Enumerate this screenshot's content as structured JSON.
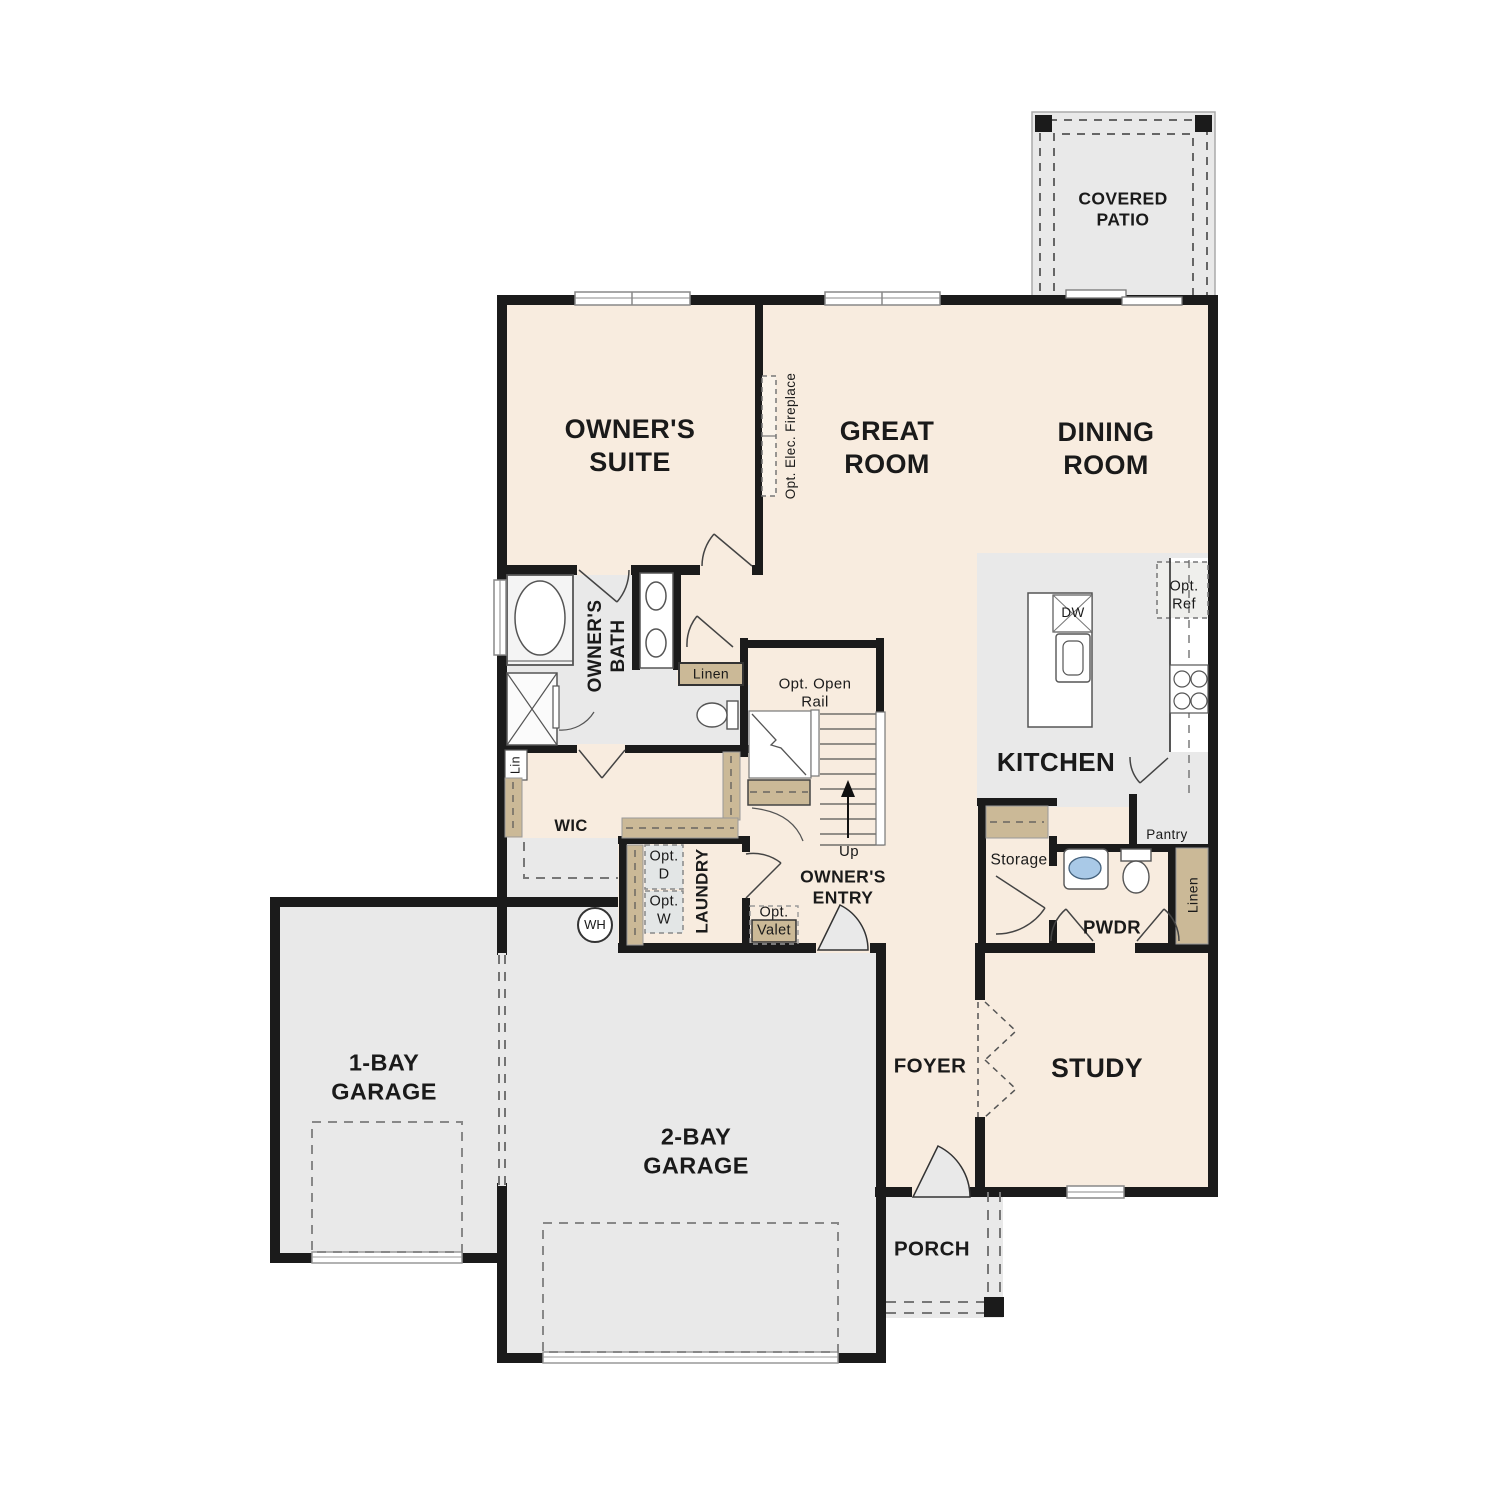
{
  "colors": {
    "paper": "#ffffff",
    "room_cream": "#f8ecdf",
    "room_gray": "#e9e9e9",
    "fixture_gray": "#f4f4f4",
    "opt_box_gray": "#e3e6e6",
    "shelf_tan": "#cbb997",
    "wall": "#1b1b1b",
    "sink_blue": "#a9c9e7"
  },
  "rooms": {
    "covered_patio": "COVERED PATIO",
    "owners_suite": "OWNER'S SUITE",
    "great_room": "GREAT ROOM",
    "dining_room": "DINING ROOM",
    "kitchen": "KITCHEN",
    "owners_bath": "OWNER'S BATH",
    "wic": "WIC",
    "laundry": "LAUNDRY",
    "owners_entry": "OWNER'S ENTRY",
    "pwdr": "PWDR",
    "foyer": "FOYER",
    "study": "STUDY",
    "porch": "PORCH",
    "garage_1bay": "1-BAY GARAGE",
    "garage_2bay": "2-BAY GARAGE"
  },
  "features": {
    "opt_elec_fireplace": "Opt. Elec. Fireplace",
    "opt_open_rail": "Opt. Open Rail",
    "up": "Up",
    "linen_bath": "Linen",
    "lin": "Lin",
    "opt_d": "Opt. D",
    "opt_w": "Opt. W",
    "wh": "WH",
    "opt_valet": "Opt. Valet",
    "storage": "Storage",
    "pantry": "Pantry",
    "opt_ref": "Opt. Ref",
    "dw": "DW",
    "linen_pwdr": "Linen"
  }
}
